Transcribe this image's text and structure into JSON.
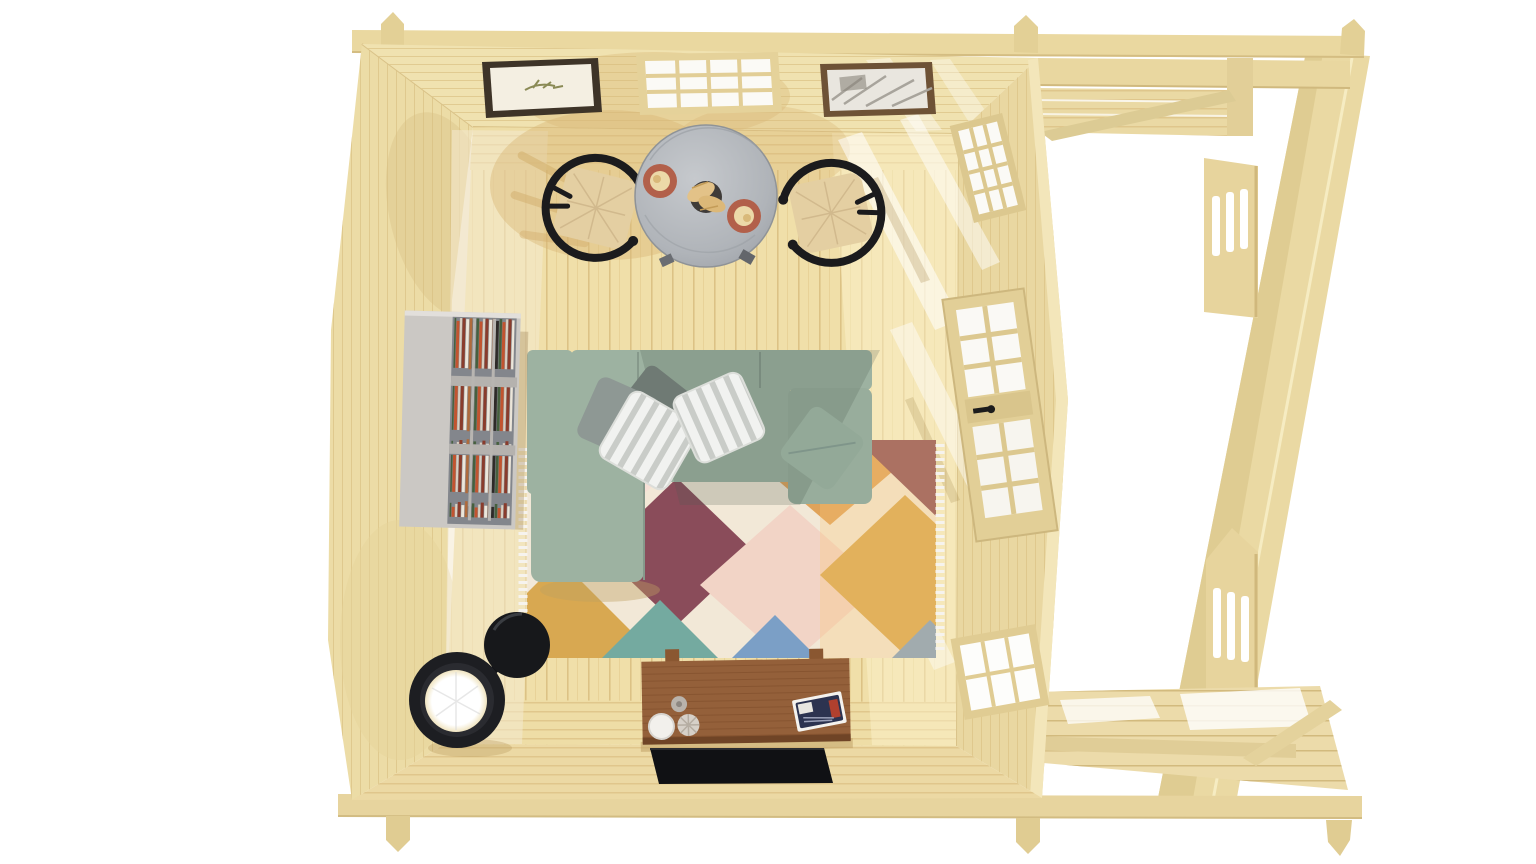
{
  "scene": {
    "description": "Overhead 3D render of a log cabin interior with an attached pergola porch on the right, white background",
    "background": "#ffffff",
    "objects": [
      "left wall",
      "top wall with two framed pictures and a grid window",
      "right wall with glazed door, upper grid window and lower grid window",
      "front wall",
      "pine plank floor",
      "pergola top beam with post caps",
      "pergola bottom beam with post caps",
      "porch ceiling joists",
      "porch corner post",
      "diagonal brace",
      "upper railing panel with three slits",
      "lower railing panel with three slits",
      "leaning right pergola post",
      "porch deck boards",
      "round grey dining table",
      "two terracotta plates with pastries",
      "dark bowl with croissants",
      "two black wishbone chairs with woven seats",
      "sage green L-shaped sectional sofa",
      "white striped pillows",
      "grey pillow",
      "sage pillow",
      "grey bookshelf filled with books",
      "multicolour diamond-pattern rug with fringe",
      "walnut media sideboard",
      "white mug",
      "ribbed cup",
      "tealight",
      "magazine stack",
      "flat black TV",
      "black floor lamp with glowing shade",
      "sunlight streaks and cast shadows"
    ]
  },
  "palette": {
    "background": "#ffffff",
    "wood": "#ead8a2",
    "wood_dark": "#d6bf85",
    "wood_light": "#f4e8c0",
    "wall_top": "#f0e2b0",
    "floor": "#f0dfa9",
    "floor_line": "#dbc083",
    "shadow_tan": "#d8b877",
    "pane": "#fbfaf6",
    "frame_dark": "#3e3428",
    "frame_brown": "#6e5236",
    "table": "#b4b8bd",
    "plate": "#b2604a",
    "pastry": "#ecd9a8",
    "bowl": "#3f3b38",
    "chair_frame": "#1b1b1d",
    "chair_seat": "#e4cfa2",
    "sofa": "#9db2a1",
    "sofa_dark": "#7f958a",
    "pillow_white": "#f1f2f0",
    "pillow_gray": "#8e9894",
    "pillow_sage": "#93a998",
    "rug_base": "#f2e8d7",
    "rug_maroon": "#8a4c5a",
    "rug_mustard": "#d8a851",
    "rug_orange": "#e0a35a",
    "rug_teal": "#74aaa0",
    "rug_blue": "#7b9fc6",
    "rug_pink": "#f2d4c6",
    "rug_blush": "#f6e0d6",
    "shelf": "#cbc8c4",
    "shelf_side": "#83868c",
    "sideboard": "#94603a",
    "tv": "#101114",
    "lamp": "#1d1e22",
    "lamp_glow": "#ffffff"
  }
}
